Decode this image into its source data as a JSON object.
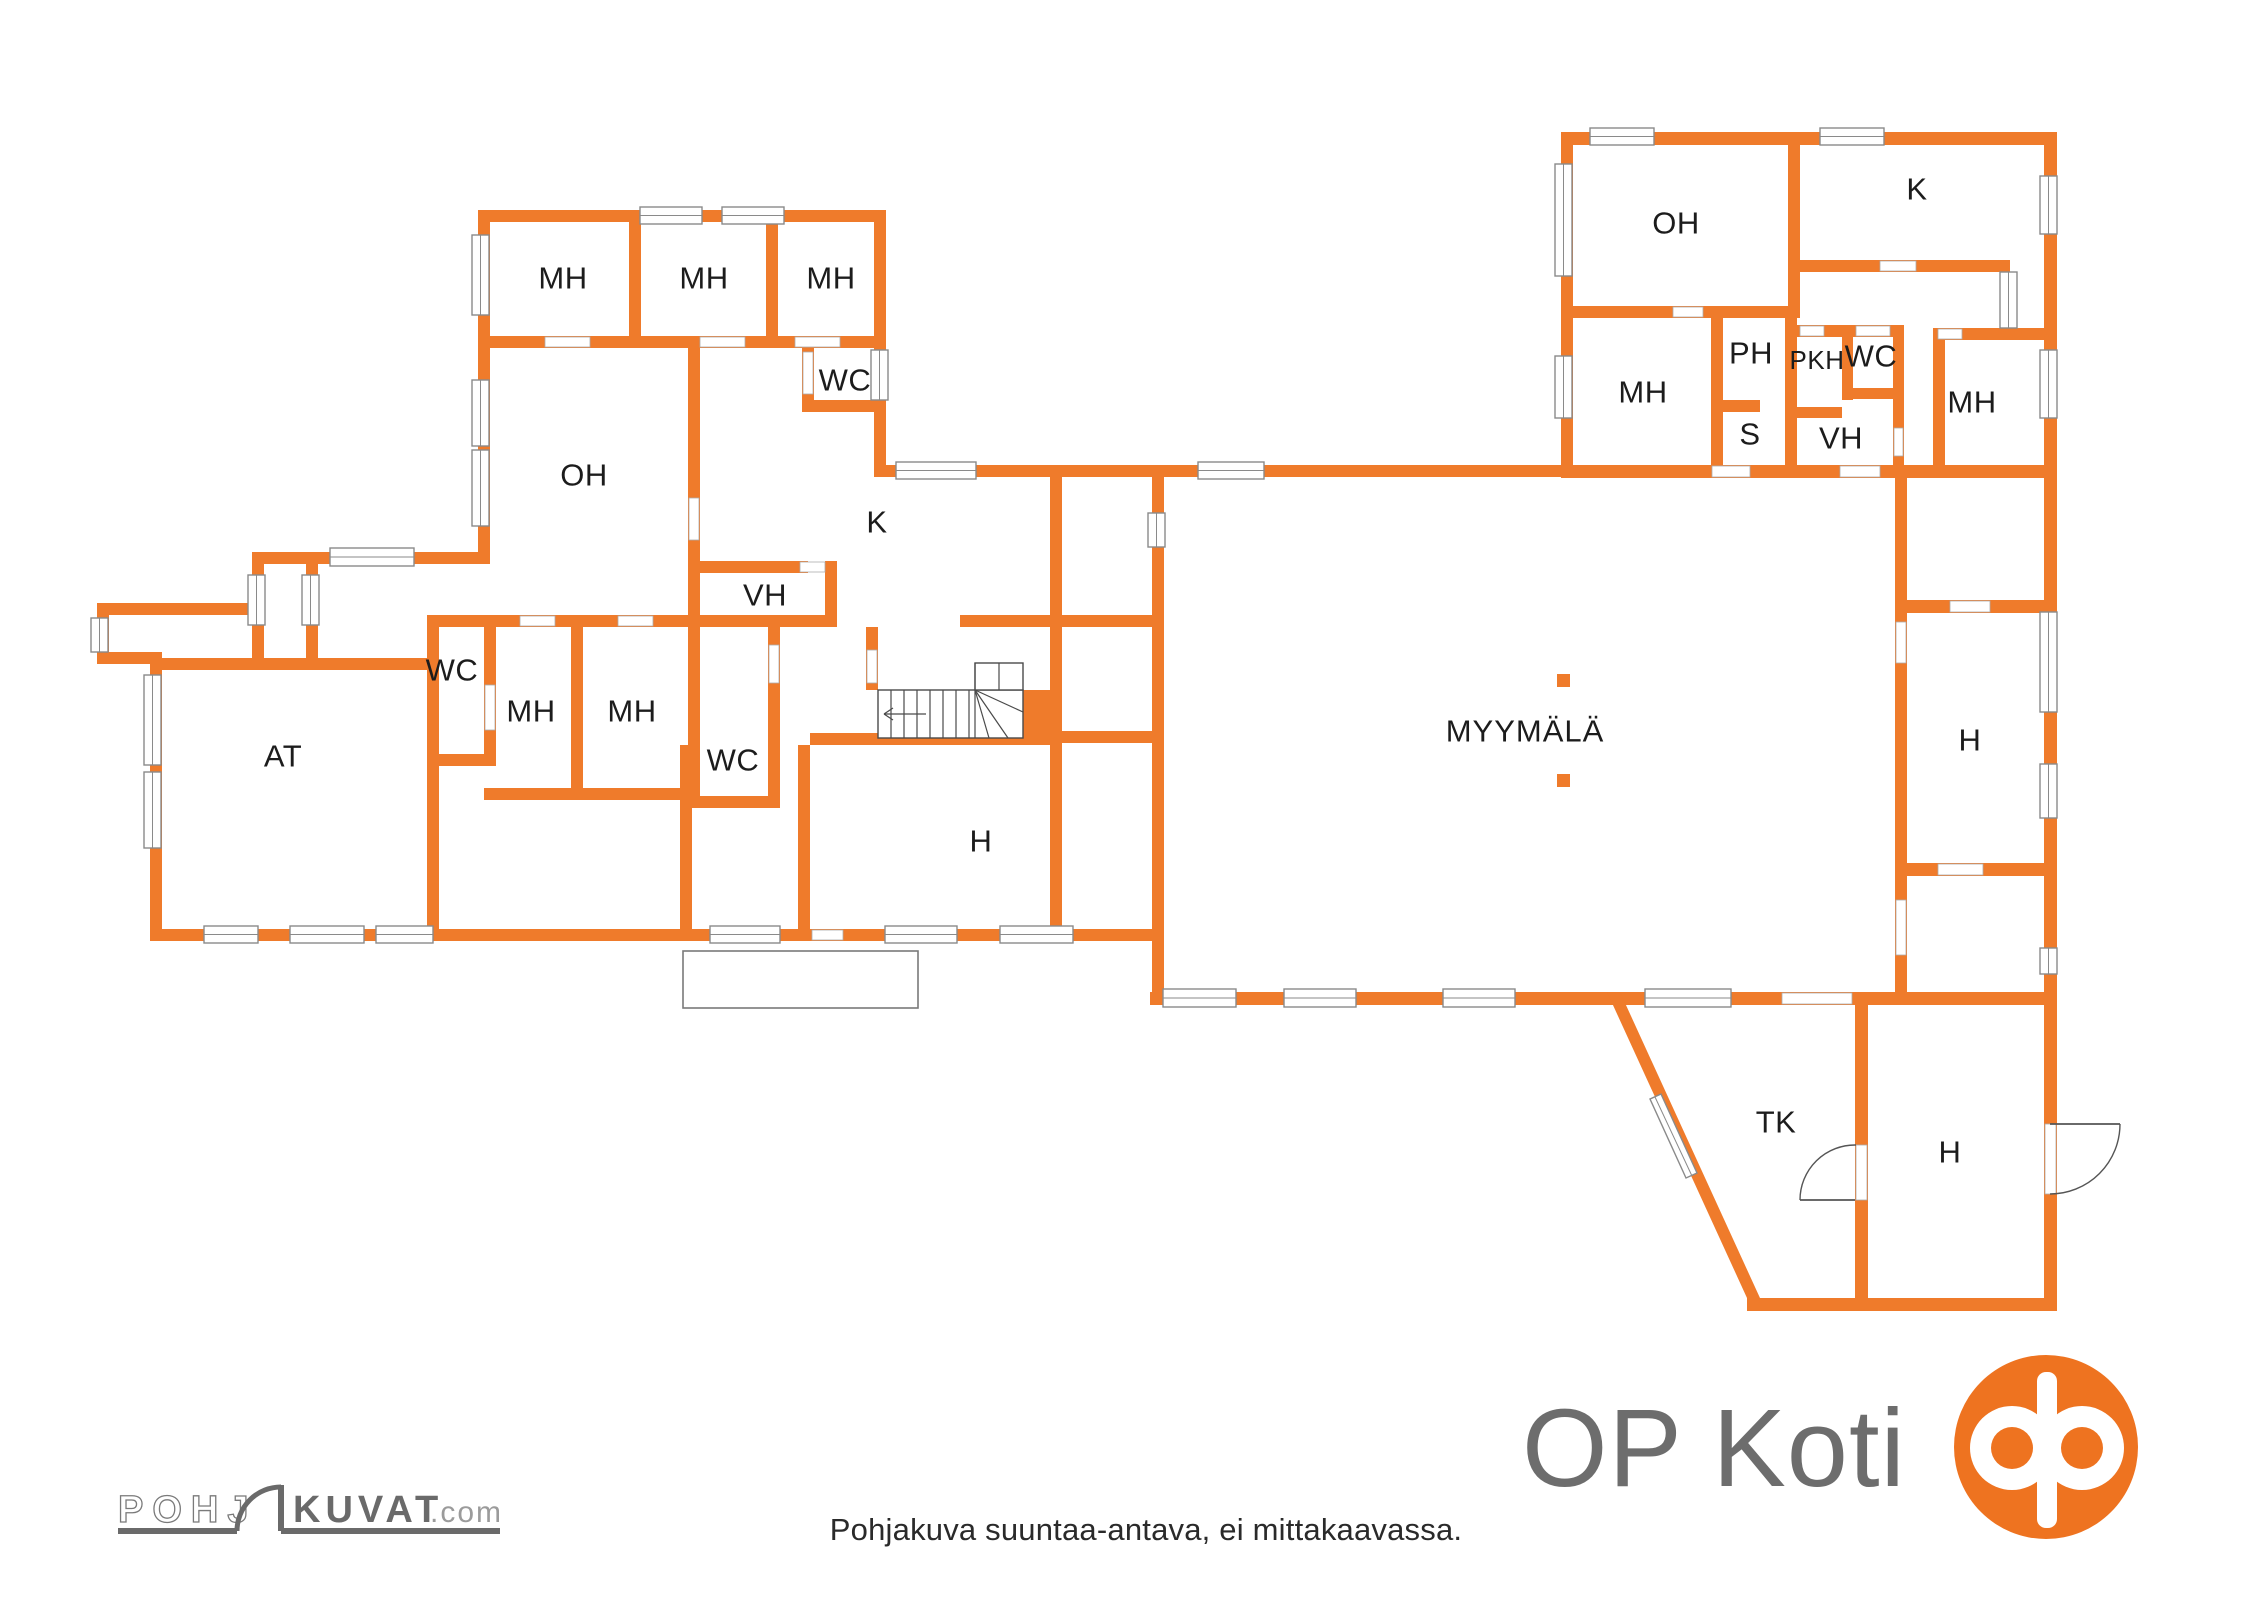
{
  "colors": {
    "wall_orange": "#EF7B2B",
    "window_border": "#8A8A8A",
    "label_text": "#1C1C1C",
    "logo_gray": "#6D6D6D",
    "logo_orange": "#EE7320",
    "footer_text": "#2A2A2A"
  },
  "rooms": {
    "mh": "MH",
    "oh": "OH",
    "wc": "WC",
    "k": "K",
    "vh": "VH",
    "at": "AT",
    "h": "H",
    "myymala": "MYYMÄLÄ",
    "tk": "TK",
    "ph": "PH",
    "pkh": "PKH",
    "s": "S"
  },
  "branding": {
    "op_koti": "OP Koti",
    "pohj": "POHJ",
    "kuvat": "KUVAT",
    "dotcom": ".com"
  },
  "footer": {
    "disclaimer": "Pohjakuva suuntaa-antava, ei mittakaavassa."
  }
}
